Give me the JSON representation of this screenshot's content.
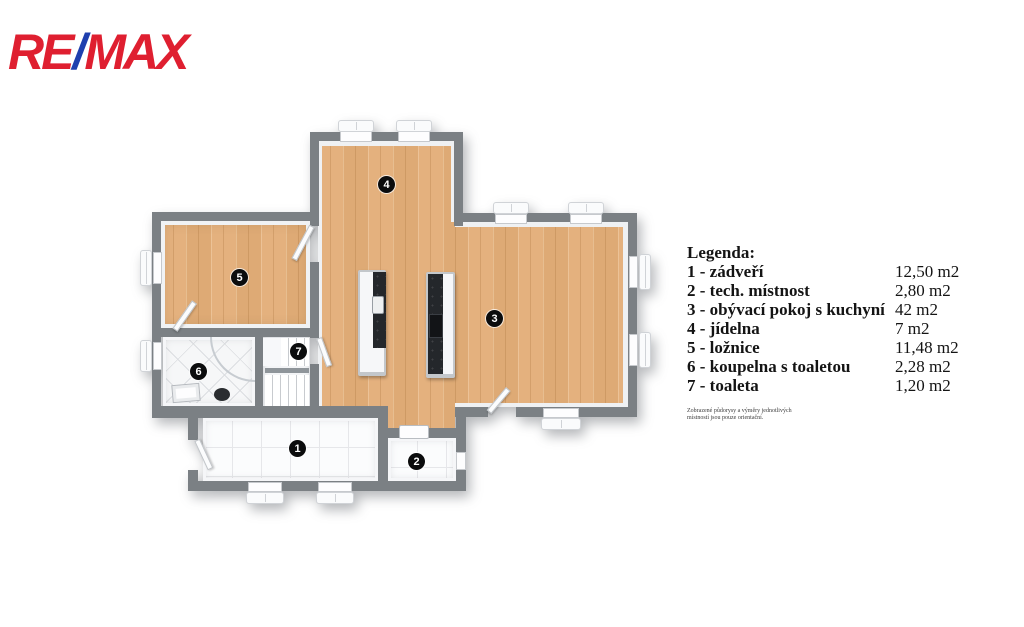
{
  "logo": {
    "re": "RE",
    "slash": "/",
    "max": "MAX"
  },
  "legend": {
    "title": "Legenda:",
    "items": [
      {
        "label": "1 - zádveří",
        "area": "12,50 m2"
      },
      {
        "label": "2 - tech. místnost",
        "area": "2,80 m2"
      },
      {
        "label": "3 - obývací pokoj s kuchyní",
        "area": "42 m2"
      },
      {
        "label": "4 - jídelna",
        "area": "7 m2"
      },
      {
        "label": "5 - ložnice",
        "area": "11,48 m2"
      },
      {
        "label": "6 - koupelna s toaletou",
        "area": "2,28 m2"
      },
      {
        "label": "7 - toaleta",
        "area": "1,20 m2"
      }
    ],
    "disclaimer": [
      "Zobrazené půdorysy a výměry jednotlivých",
      "místností jsou pouze orientační."
    ]
  },
  "floorplan": {
    "badges": [
      "1",
      "2",
      "3",
      "4",
      "5",
      "6",
      "7"
    ],
    "colors": {
      "wall": "#7b8084",
      "wood_floor": "#e4b17e",
      "tile_floor": "#fbfcfd",
      "remax_red": "#df1f30",
      "remax_blue": "#1e3fae"
    }
  }
}
